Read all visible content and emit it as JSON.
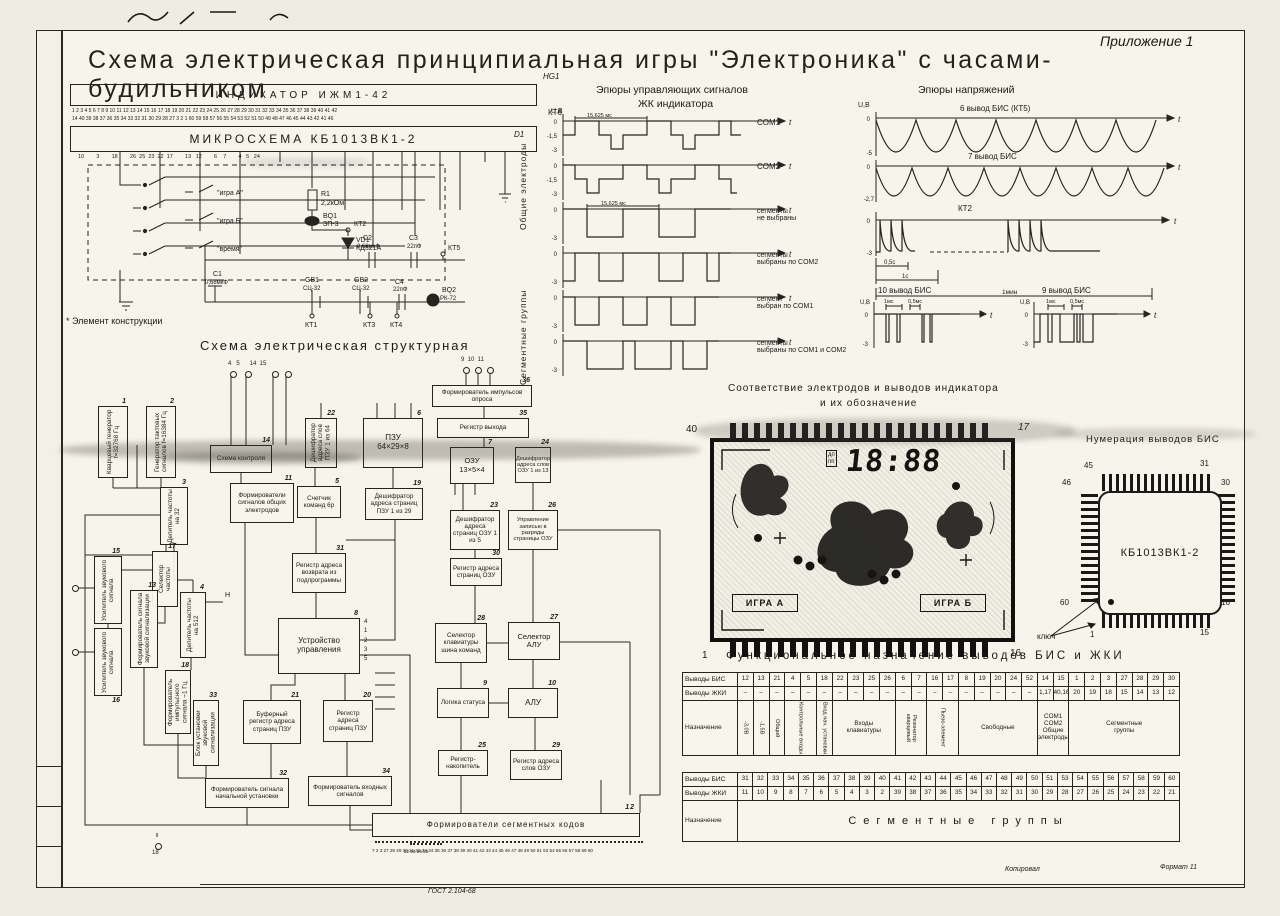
{
  "page": {
    "appendix": "Приложение 1",
    "title": "Схема электрическая принципиальная игры \"Электроника\" с часами-будильником",
    "gost": "ГОСТ 2.104-68",
    "copy": "Копировал",
    "format": "Формат 11"
  },
  "principal": {
    "ref": "HG1",
    "indicator": "ИНДИКАТОР  ИЖМ1-42",
    "chip": "МИКРОСХЕМА  КБ1013ВК1-2",
    "chip_ref": "D1",
    "kt6": "КТ6",
    "pins_top": "1 2 3 4 5 6 7 8 9 10 11 12 13 14 15 16 17 18 19 20 21 22 23 24 25 26 27 28 29 30 31 32 33 34 35 36 37 38 39 40 41 42",
    "pins_bottom": "14 40 39 38 37 36 35 34 33 32 31 30 29 28 27 3 2 1 60 59 58 57 56 55 54 53 52 51 50 49 48 47 46 45 44 43 42 41 46",
    "chip_pins": "10        3        18        26  25  23  22  17        13   12        6    7        4   5   24",
    "sw1": "\"игра А\"",
    "sw2": "\"игра Б\"",
    "sw3": "\"время\"",
    "r1": {
      "ref": "R1",
      "val": "2,2кОм"
    },
    "bq1": {
      "ref": "BQ1",
      "val": "ЗП-3"
    },
    "vd1": {
      "ref": "VD1",
      "val": "КД521А"
    },
    "c1": {
      "ref": "C1",
      "val": "0,68мкФ"
    },
    "c2": {
      "ref": "C2",
      "val": "0,68мкФ"
    },
    "c3": {
      "ref": "C3",
      "val": "22пФ"
    },
    "c4": {
      "ref": "C4",
      "val": "22пФ"
    },
    "gb1": {
      "ref": "GB1",
      "val": "СЦ-32"
    },
    "gb2": {
      "ref": "GB2",
      "val": "СЦ-32"
    },
    "bq2": {
      "ref": "BQ2",
      "val": "РК-72"
    },
    "kt1": "КТ1",
    "kt2": "КТ2",
    "kt3": "КТ3",
    "kt4": "КТ4",
    "kt5": "КТ5",
    "note": "* Элемент конструкции"
  },
  "ctrl_waves": {
    "title1": "Эпюры управляющих сигналов",
    "title2": "ЖК индикатора",
    "uaxis": "U,В",
    "period": "15,625 мс",
    "common": "Общие электроды",
    "segment": "Сегментные группы",
    "t": "t",
    "t0": "0",
    "t15": "-1,5",
    "t3": "-3",
    "r1": "COM1",
    "r2": "COM2",
    "r3": "сегменты\nне выбраны",
    "r4": "сегменты\nвыбраны по COM2",
    "r5": "сегмент\nвыбран по COM1",
    "r6": "сегменты\nвыбраны по COM1 и COM2"
  },
  "volt_waves": {
    "title": "Эпюры напряжений",
    "uaxis": "U,В",
    "t": "t",
    "zero": "0",
    "r1": "6 вывод БИС  (КТ5)",
    "r1min": "-5",
    "r2": "7 вывод БИС",
    "r2min": "-2,7",
    "r3": "КТ2",
    "r3min": "-3",
    "m05": "0,5с",
    "m1": "1с",
    "m1min": "1мин",
    "r4": "10 вывод БИС",
    "r5": "9 вывод БИС",
    "ms1": "1мс",
    "ms05": "0,5мс",
    "m3": "-3"
  },
  "structural": {
    "title": "Схема электрическая структурная",
    "pins_top": "4   5      14  15",
    "pins_mid": "9  10  11",
    "pins_right": "4\n1\n2\n3\n5",
    "h_label": "Н",
    "p18": "18",
    "group": "22 23 25 26",
    "bottom": "7 2 3 27 28 29 30 31 32 33 34 35 36 37 38 39 40 41 42 43 44 45 46 47 48 49 50 51 53 54 55 56 57 58 59 60",
    "blocks": {
      "b1": {
        "n": "1",
        "label": "Кварцевый генератор f=32768 Гц"
      },
      "b2": {
        "n": "2",
        "label": "Генератор тактовых сигналов f=16384 Гц"
      },
      "b3": {
        "n": "3",
        "label": "Делитель частоты на 32"
      },
      "b4": {
        "n": "4",
        "label": "Делитель частоты на 512"
      },
      "b5": {
        "n": "5",
        "label": "Счетчик команд 6р"
      },
      "b6": {
        "n": "6",
        "label": "ПЗУ\n64×29×8"
      },
      "b7": {
        "n": "7",
        "label": "ОЗУ\n13×5×4"
      },
      "b8": {
        "n": "8",
        "label": "Устройство управления"
      },
      "b9": {
        "n": "9",
        "label": "Логика статуса"
      },
      "b10": {
        "n": "10",
        "label": "АЛУ"
      },
      "b11": {
        "n": "11",
        "label": "Формирователи сигналов общих электродов"
      },
      "b12": {
        "n": "12",
        "label": "Формирователи сегментных кодов"
      },
      "b13": {
        "n": "13",
        "label": "Формирователь сигнала звуковой сигнализации"
      },
      "b14": {
        "n": "14",
        "label": "Схема контроля"
      },
      "b15": {
        "n": "15",
        "label": "Усилитель звукового сигнала"
      },
      "b16": {
        "n": "16",
        "label": "Усилитель звукового сигнала"
      },
      "b17": {
        "n": "17",
        "label": "Селектор частоты"
      },
      "b18": {
        "n": "18",
        "label": "Формирователь импульсного сигнала ~1 Гц"
      },
      "b19": {
        "n": "19",
        "label": "Дешифратор адреса страниц ПЗУ 1 из 29"
      },
      "b20": {
        "n": "20",
        "label": "Регистр адреса страниц ПЗУ"
      },
      "b21": {
        "n": "21",
        "label": "Буферный регистр адреса страниц ПЗУ"
      },
      "b22": {
        "n": "22",
        "label": "Дешифратор адреса слов ПЗУ 1 из 64"
      },
      "b23": {
        "n": "23",
        "label": "Дешифратор адреса страниц ОЗУ 1 из 5"
      },
      "b24": {
        "n": "24",
        "label": "Дешифратор адреса слов ОЗУ 1 из 13"
      },
      "b25": {
        "n": "25",
        "label": "Регистр-накопитель"
      },
      "b26": {
        "n": "26",
        "label": "Управление записью в разряды страницы ОЗУ"
      },
      "b27": {
        "n": "27",
        "label": "Селектор АЛУ"
      },
      "b28": {
        "n": "28",
        "label": "Селектор клавиатуры шина команд"
      },
      "b29": {
        "n": "29",
        "label": "Регистр адреса слов ОЗУ"
      },
      "b30": {
        "n": "30",
        "label": "Регистр адреса страниц ОЗУ"
      },
      "b31": {
        "n": "31",
        "label": "Регистр адреса возврата из подпрограммы"
      },
      "b32": {
        "n": "32",
        "label": "Формирователь сигнала начальной установки"
      },
      "b33": {
        "n": "33",
        "label": "Блок установки звуковой сигнализации"
      },
      "b34": {
        "n": "34",
        "label": "Формирователь входных сигналов"
      },
      "b35": {
        "n": "35",
        "label": "Регистр выхода"
      },
      "b36": {
        "n": "36",
        "label": "Формирователь импульсов опроса"
      }
    }
  },
  "correspondence": {
    "title1": "Соответствие электродов и выводов индикатора",
    "title2": "и их обозначение",
    "tl": "40",
    "tr": "17",
    "bl": "1",
    "br": "16",
    "dp": "дп\nпп",
    "digits": "18:88",
    "game_a": "ИГРА А",
    "game_b": "ИГРА Б"
  },
  "chipnum": {
    "title": "Нумерация выводов БИС",
    "label": "КБ1013ВК1-2",
    "p45": "45",
    "p31": "31",
    "p46": "46",
    "p30": "30",
    "p60": "60",
    "p16": "16",
    "p1": "1",
    "p15": "15",
    "key": "ключ"
  },
  "func_table": {
    "title": "Функциональное назначение выводов БИС и ЖКИ",
    "t1": {
      "rows": [
        {
          "label": "Выводы БИС",
          "cells": [
            "12",
            "13",
            "21",
            "4",
            "5",
            "18",
            "22",
            "23",
            "25",
            "26",
            "6",
            "7",
            "16",
            "17",
            "8",
            "19",
            "20",
            "24",
            "52",
            "14",
            "15",
            "1",
            "2",
            "3",
            "27",
            "28",
            "29",
            "30"
          ]
        },
        {
          "label": "Выводы ЖКИ",
          "cells": [
            "–",
            "–",
            "–",
            "–",
            "–",
            "–",
            "–",
            "–",
            "–",
            "–",
            "–",
            "–",
            "–",
            "–",
            "–",
            "–",
            "–",
            "–",
            "–",
            "1,17",
            "40,16",
            "20",
            "19",
            "18",
            "15",
            "14",
            "13",
            "12"
          ]
        },
        {
          "label": "Назначение",
          "cells": [
            {
              "t": "-3,0В",
              "v": 1
            },
            {
              "t": "-1,5В",
              "v": 1
            },
            {
              "t": "Общий",
              "v": 1
            },
            {
              "t": "Контрольные входы",
              "c": 2,
              "v": 1
            },
            {
              "t": "Вход нач. установки",
              "v": 1
            },
            {
              "t": "Входы\nклавиатуры",
              "c": 4
            },
            {
              "t": "Резонатор кварцевый",
              "c": 2,
              "v": 1
            },
            {
              "t": "Пьезо-элемент",
              "c": 2,
              "v": 1
            },
            {
              "t": "Свободные",
              "c": 5
            },
            {
              "t": "COM1 COM2\nОбщие\nэлектроды",
              "c": 2
            },
            {
              "t": "Сегментные\nгруппы",
              "c": 7
            }
          ]
        }
      ]
    },
    "t2": {
      "rows": [
        {
          "label": "Выводы БИС",
          "cells": [
            "31",
            "32",
            "33",
            "34",
            "35",
            "36",
            "37",
            "38",
            "39",
            "40",
            "41",
            "42",
            "43",
            "44",
            "45",
            "46",
            "47",
            "48",
            "49",
            "50",
            "51",
            "53",
            "54",
            "55",
            "56",
            "57",
            "58",
            "59",
            "60"
          ]
        },
        {
          "label": "Выводы ЖКИ",
          "cells": [
            "11",
            "10",
            "9",
            "8",
            "7",
            "6",
            "5",
            "4",
            "3",
            "2",
            "39",
            "38",
            "37",
            "36",
            "35",
            "34",
            "33",
            "32",
            "31",
            "30",
            "29",
            "28",
            "27",
            "26",
            "25",
            "24",
            "23",
            "22",
            "21"
          ]
        },
        {
          "label": "Назначение",
          "cells": [
            {
              "t": "Сегментные       группы",
              "c": 29,
              "cls": "big"
            }
          ]
        }
      ]
    }
  }
}
